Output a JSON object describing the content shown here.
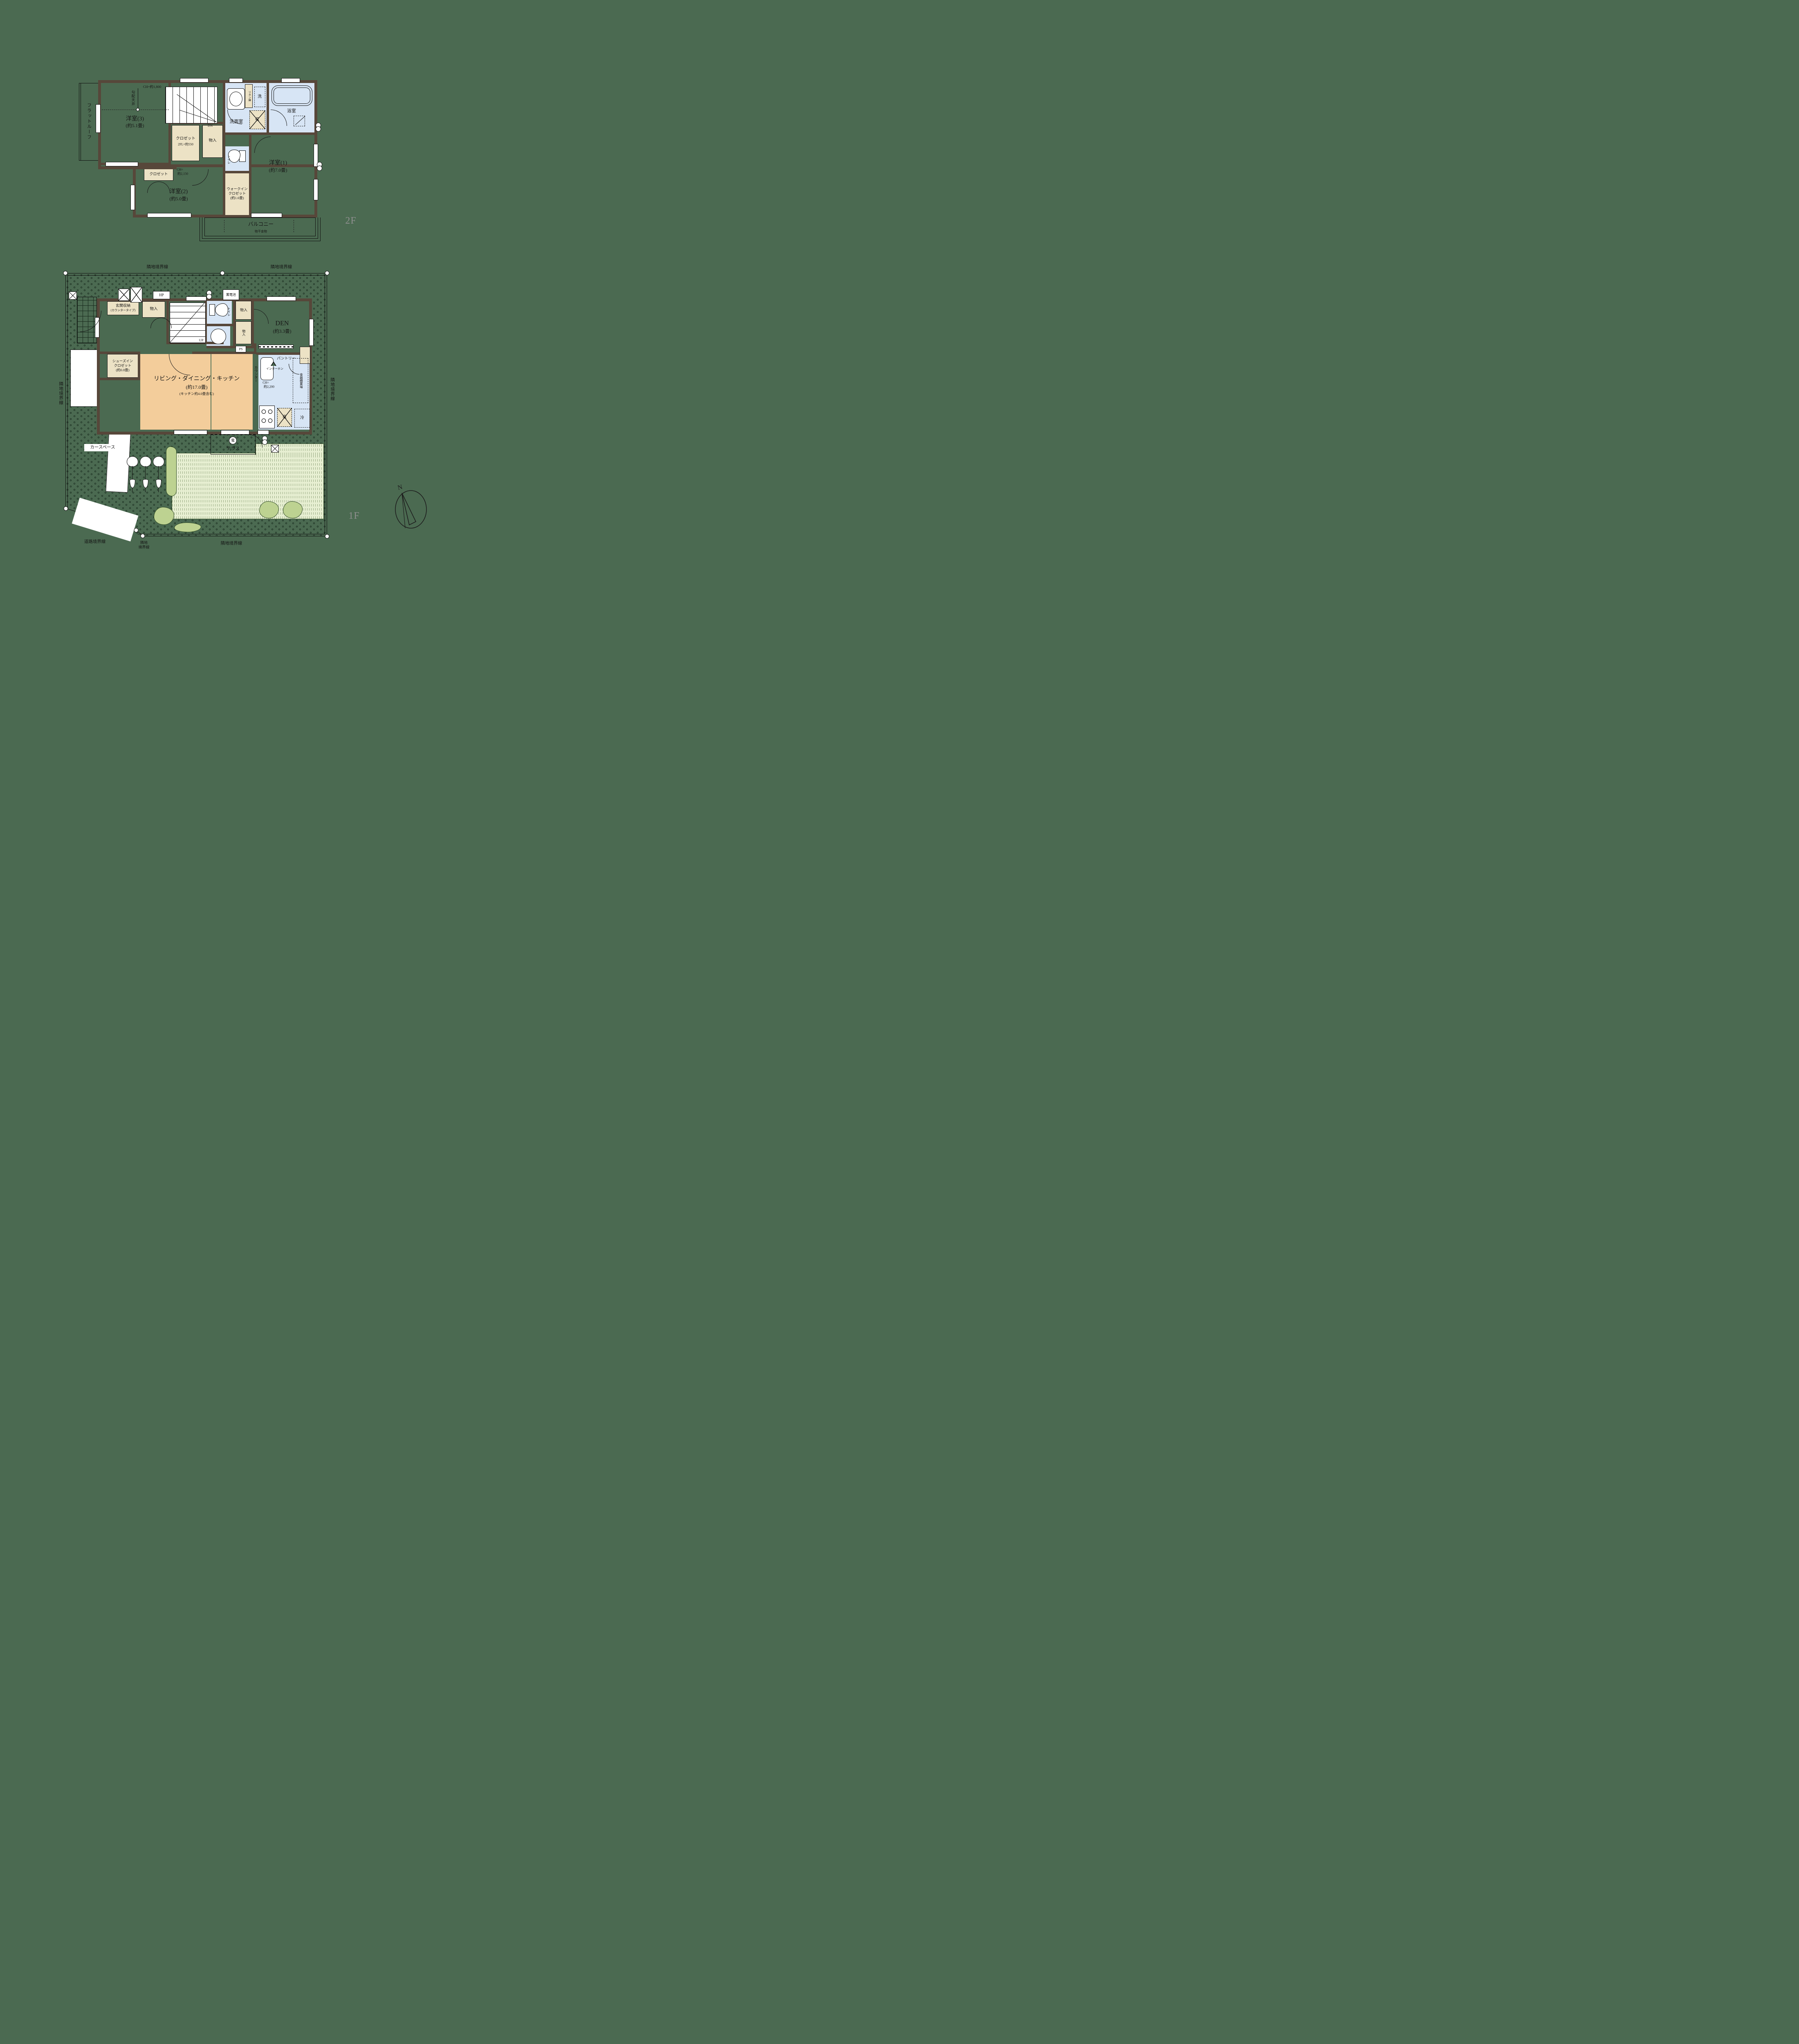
{
  "palette": {
    "background": "#4b6a51",
    "wall": "#57473a",
    "closet_cream": "#ece2c5",
    "water_blue": "#d7e5f5",
    "ldk_orange": "#f3cd9b",
    "lawn_green": "#e7efd2",
    "bush_green": "#bdd291",
    "floor_tag_gray": "#8f8f8f"
  },
  "f2": {
    "floor_tag": "2F",
    "flat_roof": "フラットルーフ",
    "slope_ceiling": "勾配天井",
    "ch_1800": "CH=約1,800",
    "ch_2150_l1": "CH=",
    "ch_2150_l2": "約2,150",
    "dn": "DN",
    "yoshitsu3_name": "洋室(3)",
    "yoshitsu3_size": "(約5.1畳)",
    "closet_name": "クロゼット",
    "closet_note": "2FL+約550",
    "monoire": "物入",
    "linen": "リネン庫",
    "washer": "洗",
    "senmen": "洗面室",
    "shuu": "収",
    "bath": "浴室",
    "toilet": "トイレ",
    "wic_l1": "ウォークイン",
    "wic_l2": "クロゼット",
    "wic_l3": "(約1.6畳)",
    "yoshitsu1_name": "洋室(1)",
    "yoshitsu1_size": "(約7.0畳)",
    "closet2_name": "クロゼット",
    "yoshitsu2_name": "洋室(2)",
    "yoshitsu2_size": "(約5.0畳)",
    "balcony": "バルコニー",
    "hanger": "物干金物"
  },
  "f1": {
    "floor_tag": "1F",
    "boundary_top_left": "隣地境界線",
    "boundary_top_right": "隣地境界線",
    "boundary_right": "隣地境界線",
    "boundary_left": "隣地境界線",
    "boundary_bottom": "隣地境界線",
    "boundary_corner_l1": "隣地",
    "boundary_corner_l2": "境界線",
    "road_boundary": "道路境界線",
    "hp": "HP",
    "battery": "蓄電池",
    "genkan_l1": "玄関収納",
    "genkan_l2": "(カウンタータイプ)",
    "monoire_a": "物入",
    "monoire_b": "物入",
    "monoire_c": "物入",
    "toilet": "トイレ",
    "ps": "PS",
    "up": "UP",
    "den_name": "DEN",
    "den_size": "(約3.3畳)",
    "sic_l1": "シューズイン",
    "sic_l2": "クロゼット",
    "sic_l3": "(約0.8畳)",
    "ldk_name": "リビング・ダイニング・キッチン",
    "ldk_size": "(約17.0畳)",
    "ldk_note": "(キッチン約4.0畳含む)",
    "counter": "カウンター",
    "ch_2200_l1": "CH=",
    "ch_2200_l2": "約2,200",
    "intercom": "インターホン",
    "pantry": "パントリー",
    "cupboard": "食器棚置場",
    "shuu": "収",
    "fridge": "冷",
    "terrace": "テラス",
    "ev": "電",
    "car_space": "カースペース",
    "compass_n": "N"
  }
}
